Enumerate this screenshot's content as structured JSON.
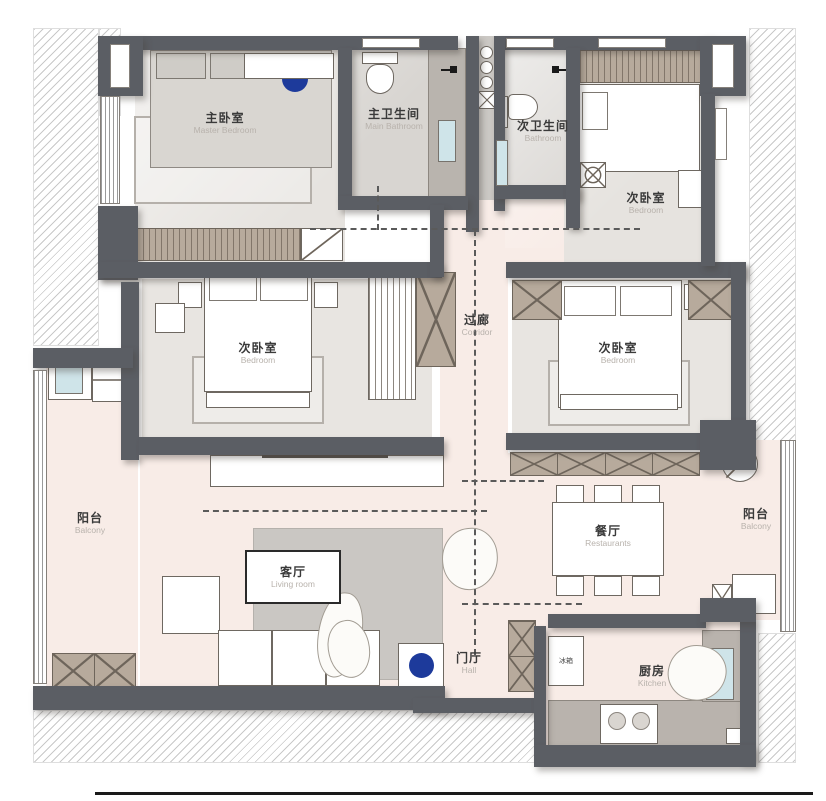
{
  "rooms": {
    "master_bedroom": {
      "zh": "主卧室",
      "en": "Master Bedroom"
    },
    "main_bathroom": {
      "zh": "主卫生间",
      "en": "Main Bathroom"
    },
    "second_bathroom": {
      "zh": "次卫生间",
      "en": "Bathroom"
    },
    "bedroom_ne": {
      "zh": "次卧室",
      "en": "Bedroom"
    },
    "bedroom_west": {
      "zh": "次卧室",
      "en": "Bedroom"
    },
    "bedroom_east": {
      "zh": "次卧室",
      "en": "Bedroom"
    },
    "corridor": {
      "zh": "过廊",
      "en": "Corridor"
    },
    "balcony_left": {
      "zh": "阳台",
      "en": "Balcony"
    },
    "balcony_right": {
      "zh": "阳台",
      "en": "Balcony"
    },
    "living_room": {
      "zh": "客厅",
      "en": "Living room"
    },
    "dining_room": {
      "zh": "餐厅",
      "en": "Restaurants"
    },
    "hall": {
      "zh": "门厅",
      "en": "Hall"
    },
    "kitchen": {
      "zh": "厨房",
      "en": "Kitchen"
    }
  },
  "appliances": {
    "fridge": {
      "zh": "冰箱"
    }
  },
  "colors": {
    "wall": "#5b5e64",
    "floor_warm": "#f8ece7",
    "floor_gray": "#e6e3df",
    "accent_blue": "#1d3a9b",
    "hatch_brown": "#b7aa9c"
  }
}
